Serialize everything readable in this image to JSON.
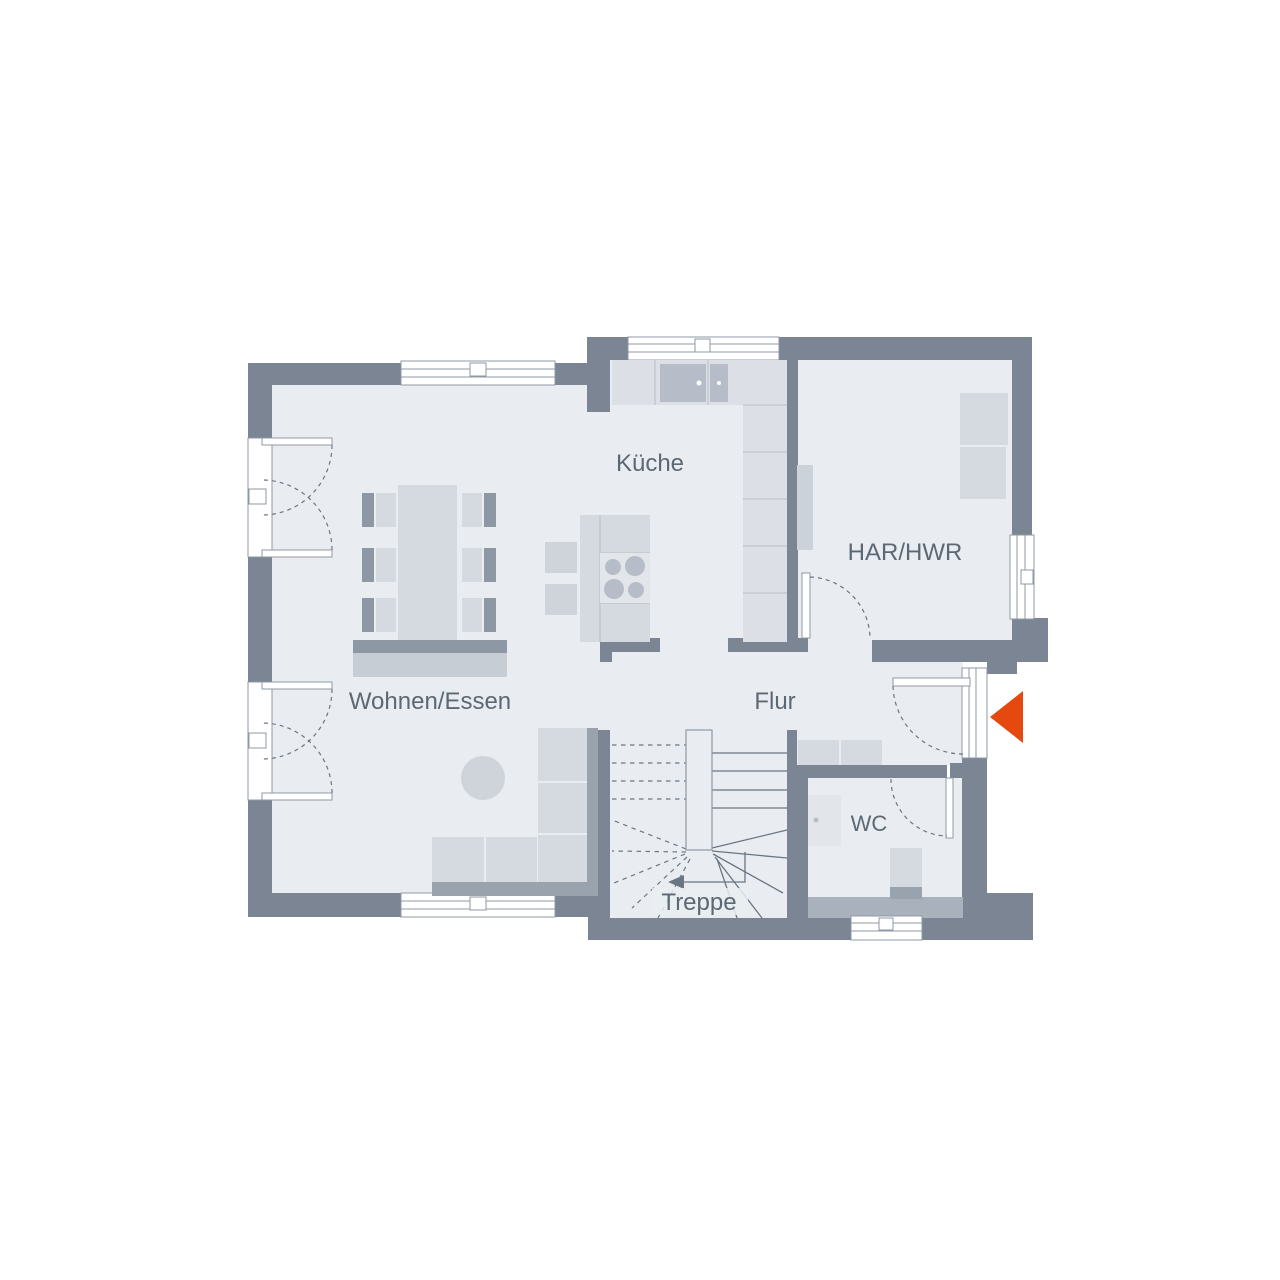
{
  "plan": {
    "title": "Grundriss Erdgeschoss",
    "rooms": {
      "kueche": {
        "label": "Küche"
      },
      "har_hwr": {
        "label": "HAR/HWR"
      },
      "wohnen_essen": {
        "label": "Wohnen/Essen"
      },
      "flur": {
        "label": "Flur"
      },
      "wc": {
        "label": "WC"
      },
      "treppe": {
        "label": "Treppe"
      }
    },
    "icons": {
      "entrance_arrow": "entrance-direction-triangle-pointing-left"
    },
    "colors": {
      "background": "#ffffff",
      "wall": "#7b8593",
      "wall_inner": "#a9b1bc",
      "floor": "#e9edf1",
      "furniture": "#d5d9e0",
      "furniture_2": "#cfd4db",
      "counter": "#dce0e6",
      "appliance": "#b6bdc8",
      "seat_back": "#8e98a4",
      "sofa_back": "#99a3ae",
      "panel": "#e2e5ea",
      "shelf": "#ccd2da",
      "sideboard": "#c7cdd5",
      "outline": "#8f99a5",
      "stair_line": "#6b7683",
      "label_text": "#5c6874",
      "entrance_arrow": "#e5490f"
    }
  }
}
